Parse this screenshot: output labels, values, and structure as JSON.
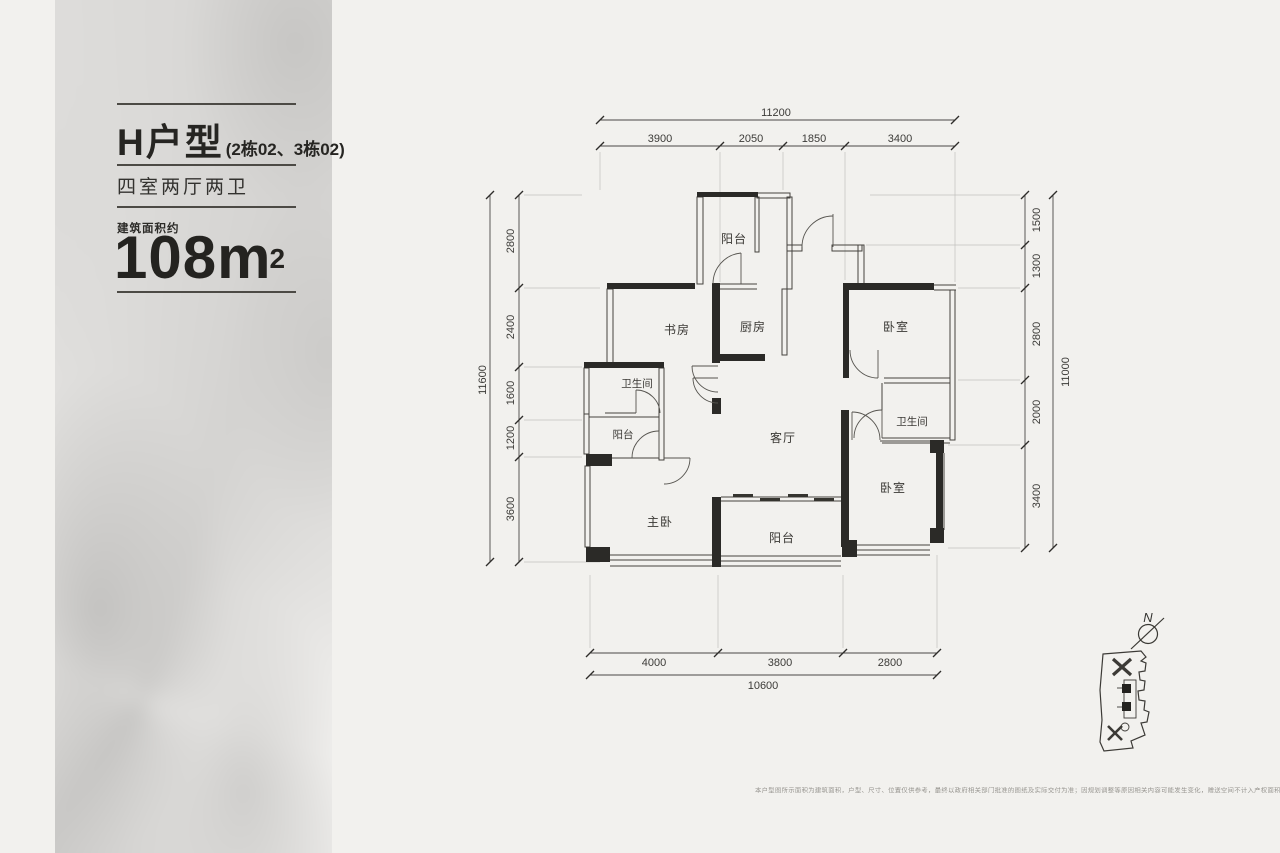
{
  "panel": {
    "type_title": "H户型",
    "type_sub": "(2栋02、3栋02)",
    "layout_label": "四室两厅两卫",
    "area_label": "建筑面积约",
    "area_number": "108m",
    "area_sup": "2"
  },
  "plan": {
    "room_labels": {
      "balcony_top": "阳台",
      "study": "书房",
      "kitchen": "厨房",
      "bedroom_top_right": "卧室",
      "bath_left": "卫生间",
      "balcony_left": "阳台",
      "living": "客厅",
      "bath_right": "卫生间",
      "master": "主卧",
      "balcony_bottom": "阳台",
      "bedroom_bottom_right": "卧室"
    },
    "dims": {
      "top": {
        "total": "11200",
        "segments": [
          "3900",
          "2050",
          "1850",
          "3400"
        ]
      },
      "left": {
        "total": "11600",
        "segments": [
          "2800",
          "2400",
          "1600",
          "1200",
          "3600"
        ]
      },
      "right": {
        "total": "11000",
        "segments": [
          "1500",
          "1300",
          "2800",
          "2000",
          "3400"
        ]
      },
      "bottom": {
        "total": "10600",
        "segments": [
          "4000",
          "3800",
          "2800"
        ]
      }
    },
    "north_label": "N"
  },
  "footer": {
    "disclaimer": "本户型图所示面积为建筑面积，户型、尺寸、位置仅供参考，最终以政府相关部门批准的图纸及实际交付为准；因规划调整等原因相关内容可能发生变化，赠送空间不计入产权面积，具体以商品房买卖合同及附件等协议文件约定为准。"
  },
  "colors": {
    "background": "#f2f1ee",
    "wall": "#2b2a27",
    "text": "#2a2927"
  }
}
